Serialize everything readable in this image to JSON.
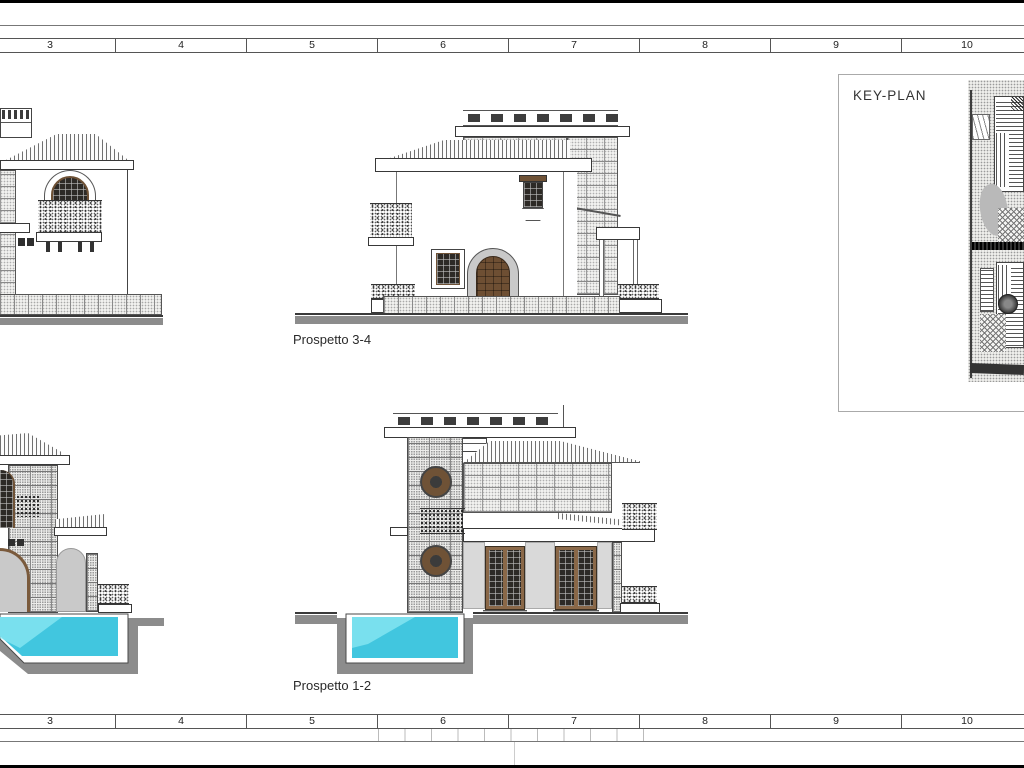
{
  "sheet": {
    "type": "architectural-elevation-drawing",
    "labels": {
      "top_elevation": "Prospetto 3-4",
      "bottom_elevation": "Prospetto 1-2",
      "keyplan_title": "KEY-PLAN"
    },
    "ruler": {
      "numbers": [
        "3",
        "4",
        "5",
        "6",
        "7",
        "8",
        "9",
        "10"
      ]
    },
    "colors": {
      "pool_water": "#41c6df",
      "pool_water_highlight": "#8ce8f3",
      "pool_shell_white": "#ffffff",
      "pool_wall_gray": "#8c8c8c",
      "ground_gray": "#8c8c8c",
      "door_brown": "#6e4f33",
      "frame_brown": "#6f5236",
      "window_dark": "#2d2a26",
      "surround_gray": "#c9c9c9",
      "pilaster_gray": "#d9d9d9",
      "line": "#3a3a3a"
    }
  }
}
